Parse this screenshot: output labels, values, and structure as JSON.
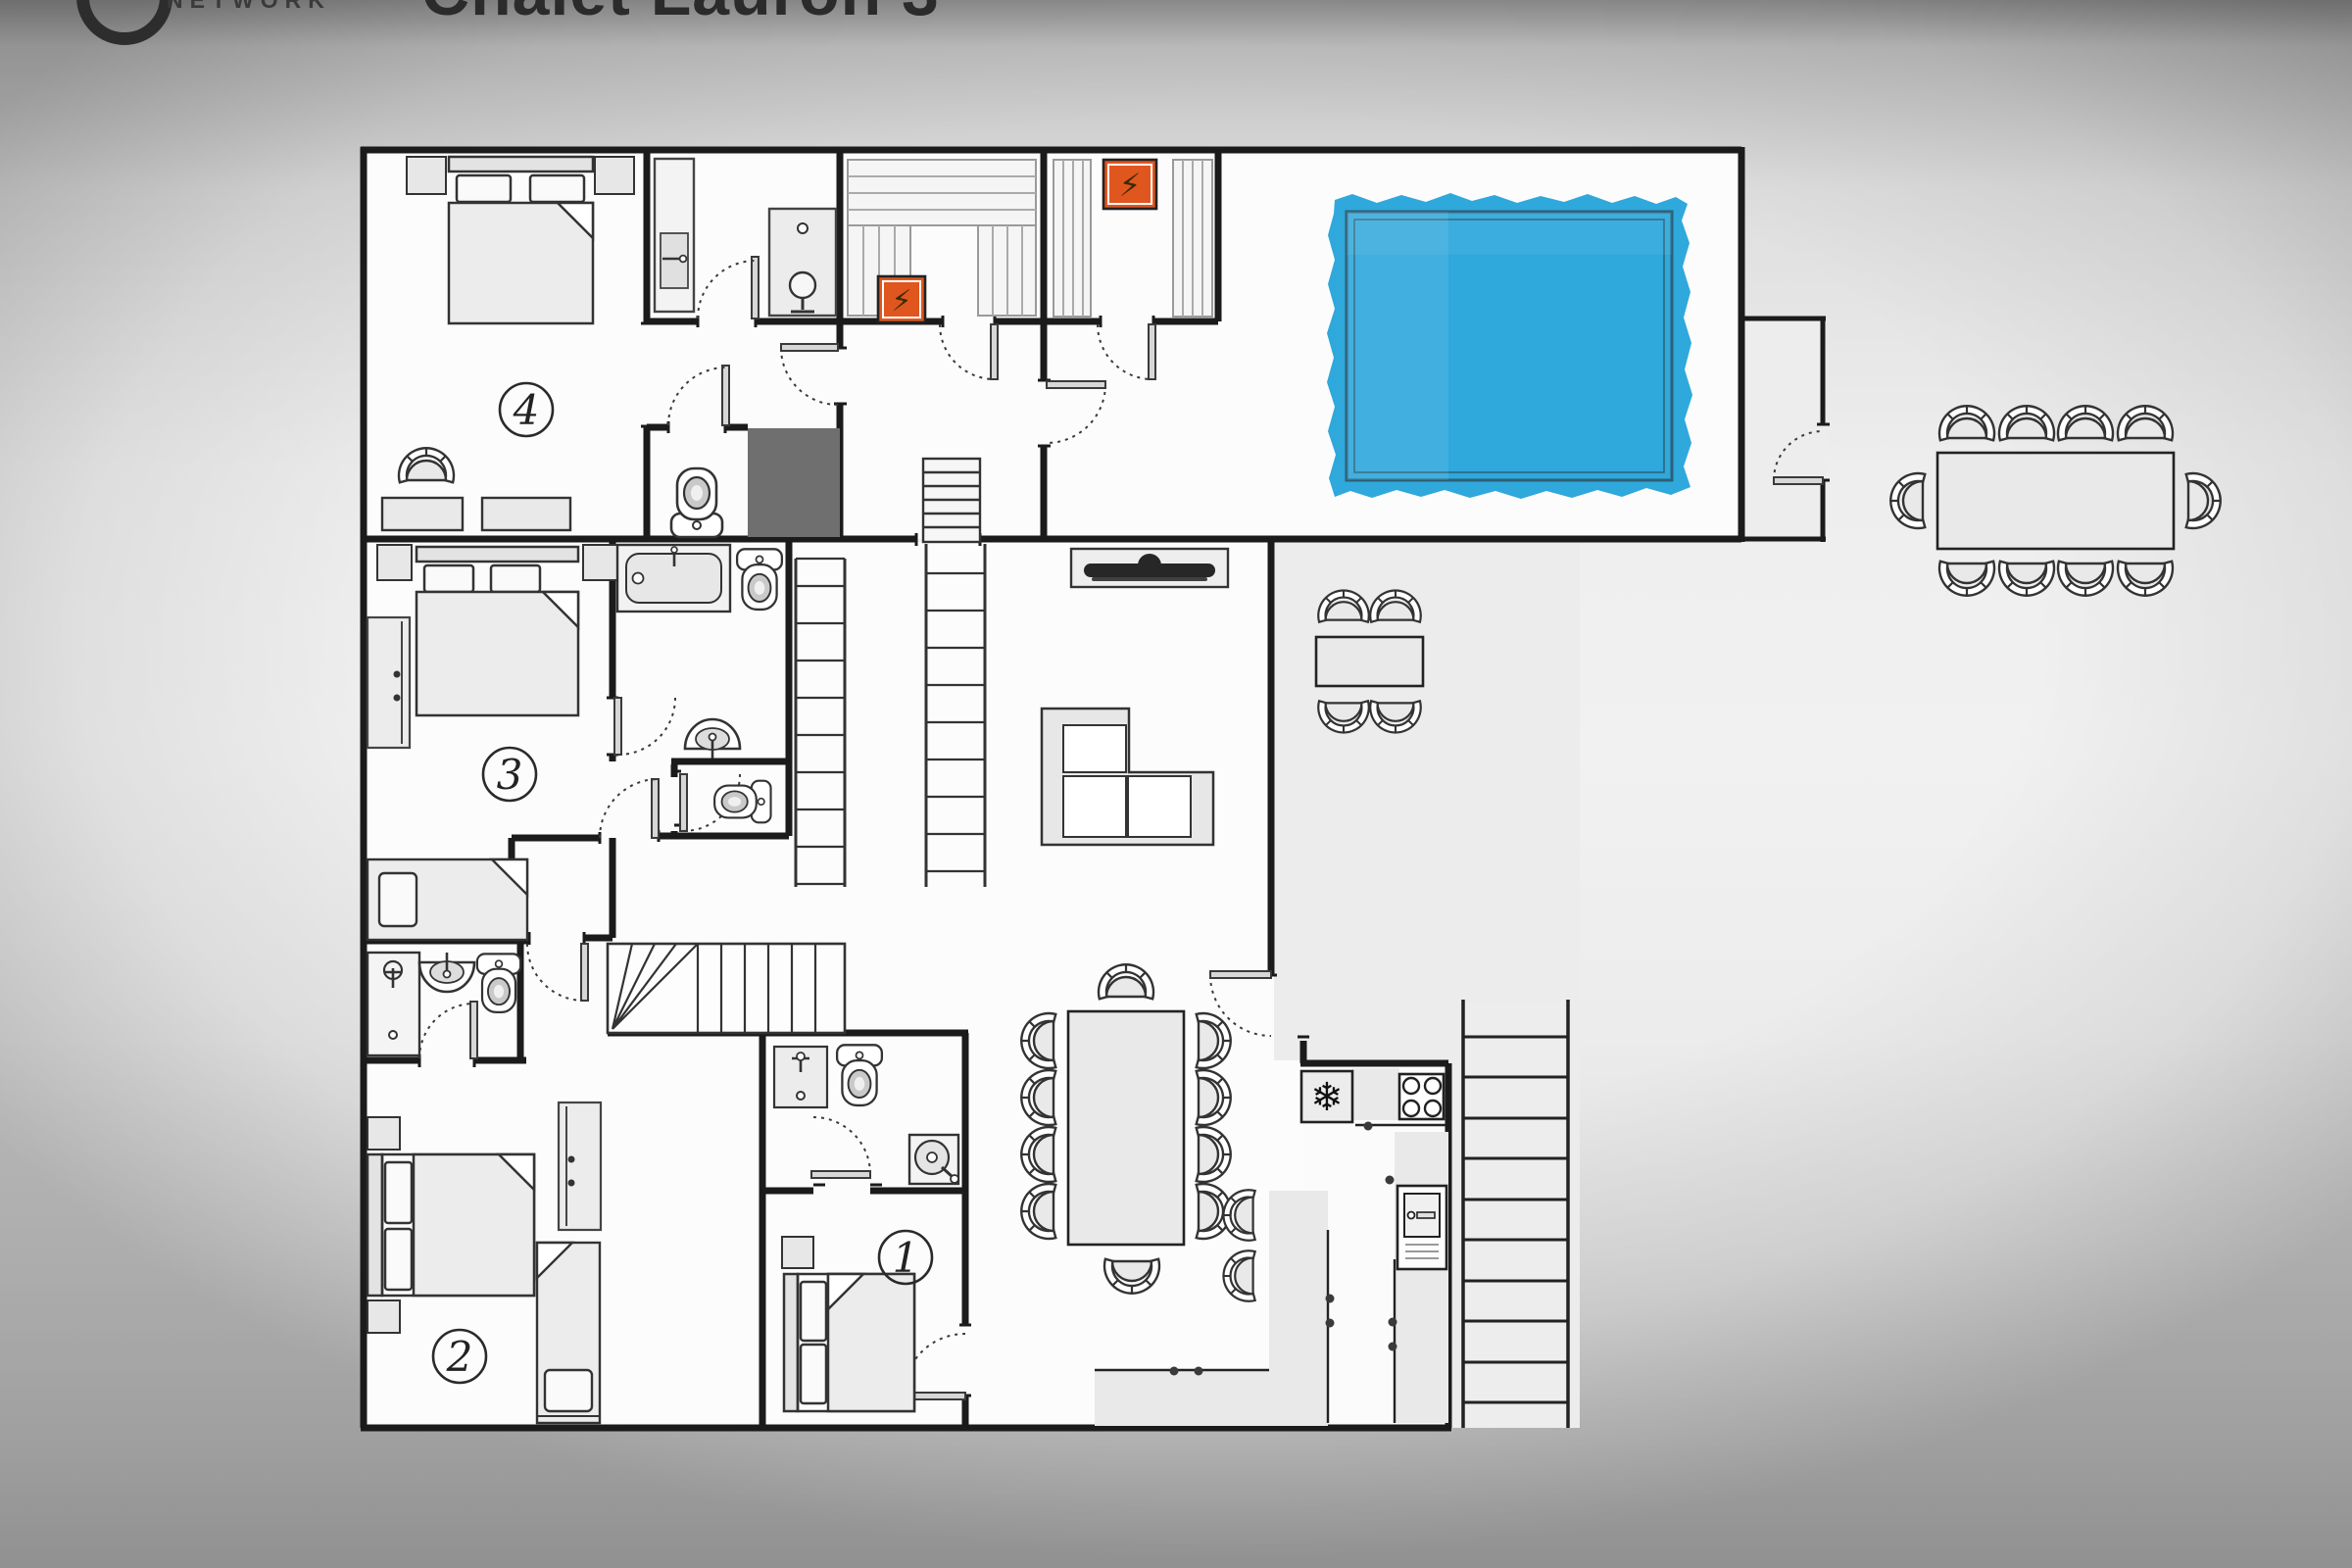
{
  "header": {
    "logo_text": "NETWORK",
    "title": "Chalet Lauron 3"
  },
  "floorplan": {
    "rooms": [
      {
        "id": "room-1",
        "label": "1"
      },
      {
        "id": "room-2",
        "label": "2"
      },
      {
        "id": "room-3",
        "label": "3"
      },
      {
        "id": "room-4",
        "label": "4"
      }
    ],
    "icons": {
      "sauna_heater": "⚡",
      "fridge": "❄"
    },
    "colors": {
      "pool": "#2FA8DC",
      "pool_border": "#2D6076",
      "sauna_heater": "#E0561F",
      "storage_dark": "#6F6F6F",
      "walls": "#1B1B1B"
    }
  }
}
